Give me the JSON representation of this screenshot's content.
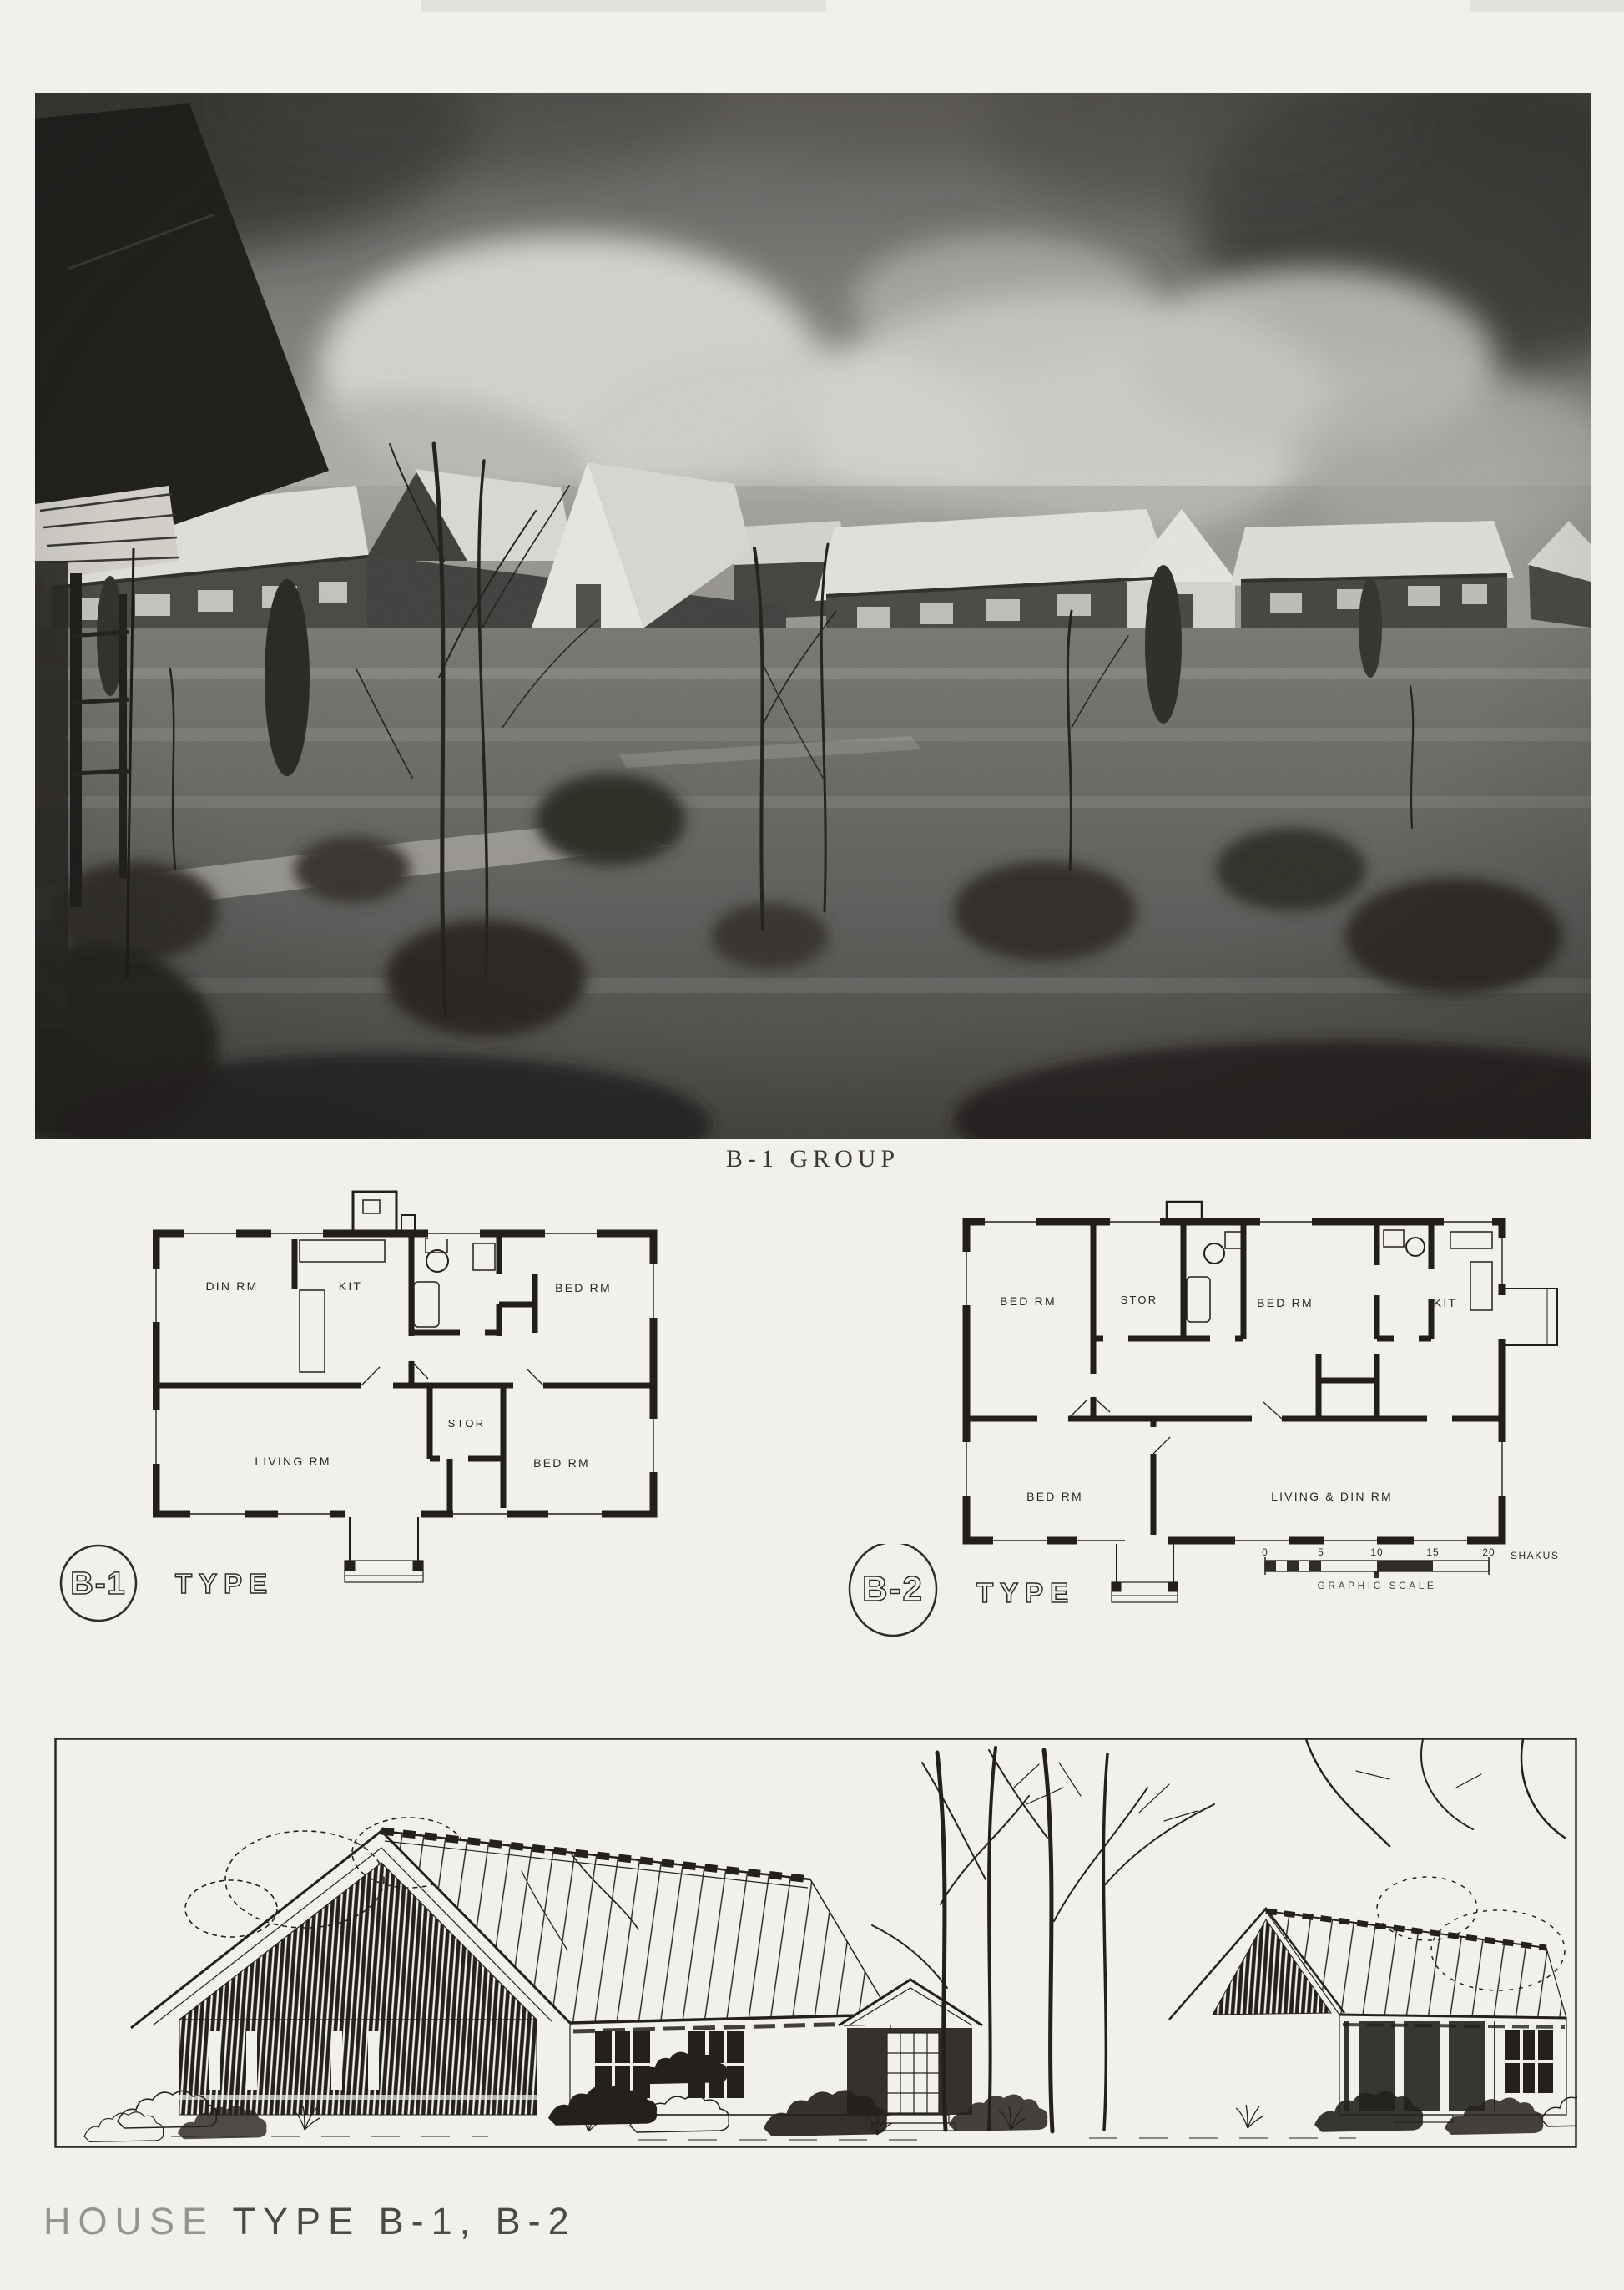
{
  "page": {
    "paper_color": "#f1f0ed",
    "ink_color": "#221f1b"
  },
  "photo": {
    "caption": "B-1 GROUP"
  },
  "plan_b1": {
    "badge": "B-1",
    "type_label": "TYPE",
    "rooms": {
      "din_rm": "DIN RM",
      "kit": "KIT",
      "bed_rm_top": "BED RM",
      "stor": "STOR",
      "living_rm": "LIVING RM",
      "bed_rm_bottom": "BED RM"
    }
  },
  "plan_b2": {
    "badge": "B-2",
    "type_label": "TYPE",
    "rooms": {
      "bed_rm_top_left": "BED RM",
      "stor": "STOR",
      "bed_rm_top_mid": "BED RM",
      "kit": "KIT",
      "bed_rm_bottom_left": "BED RM",
      "living_din_rm": "LIVING & DIN RM"
    }
  },
  "graphic_scale": {
    "ticks": [
      "0",
      "5",
      "10",
      "15",
      "20"
    ],
    "unit": "SHAKUS",
    "label": "GRAPHIC SCALE"
  },
  "footer": {
    "title_word": "HOUSE",
    "title_rest": "TYPE B-1, B-2",
    "full_title": "HOUSE TYPE B-1, B-2"
  }
}
